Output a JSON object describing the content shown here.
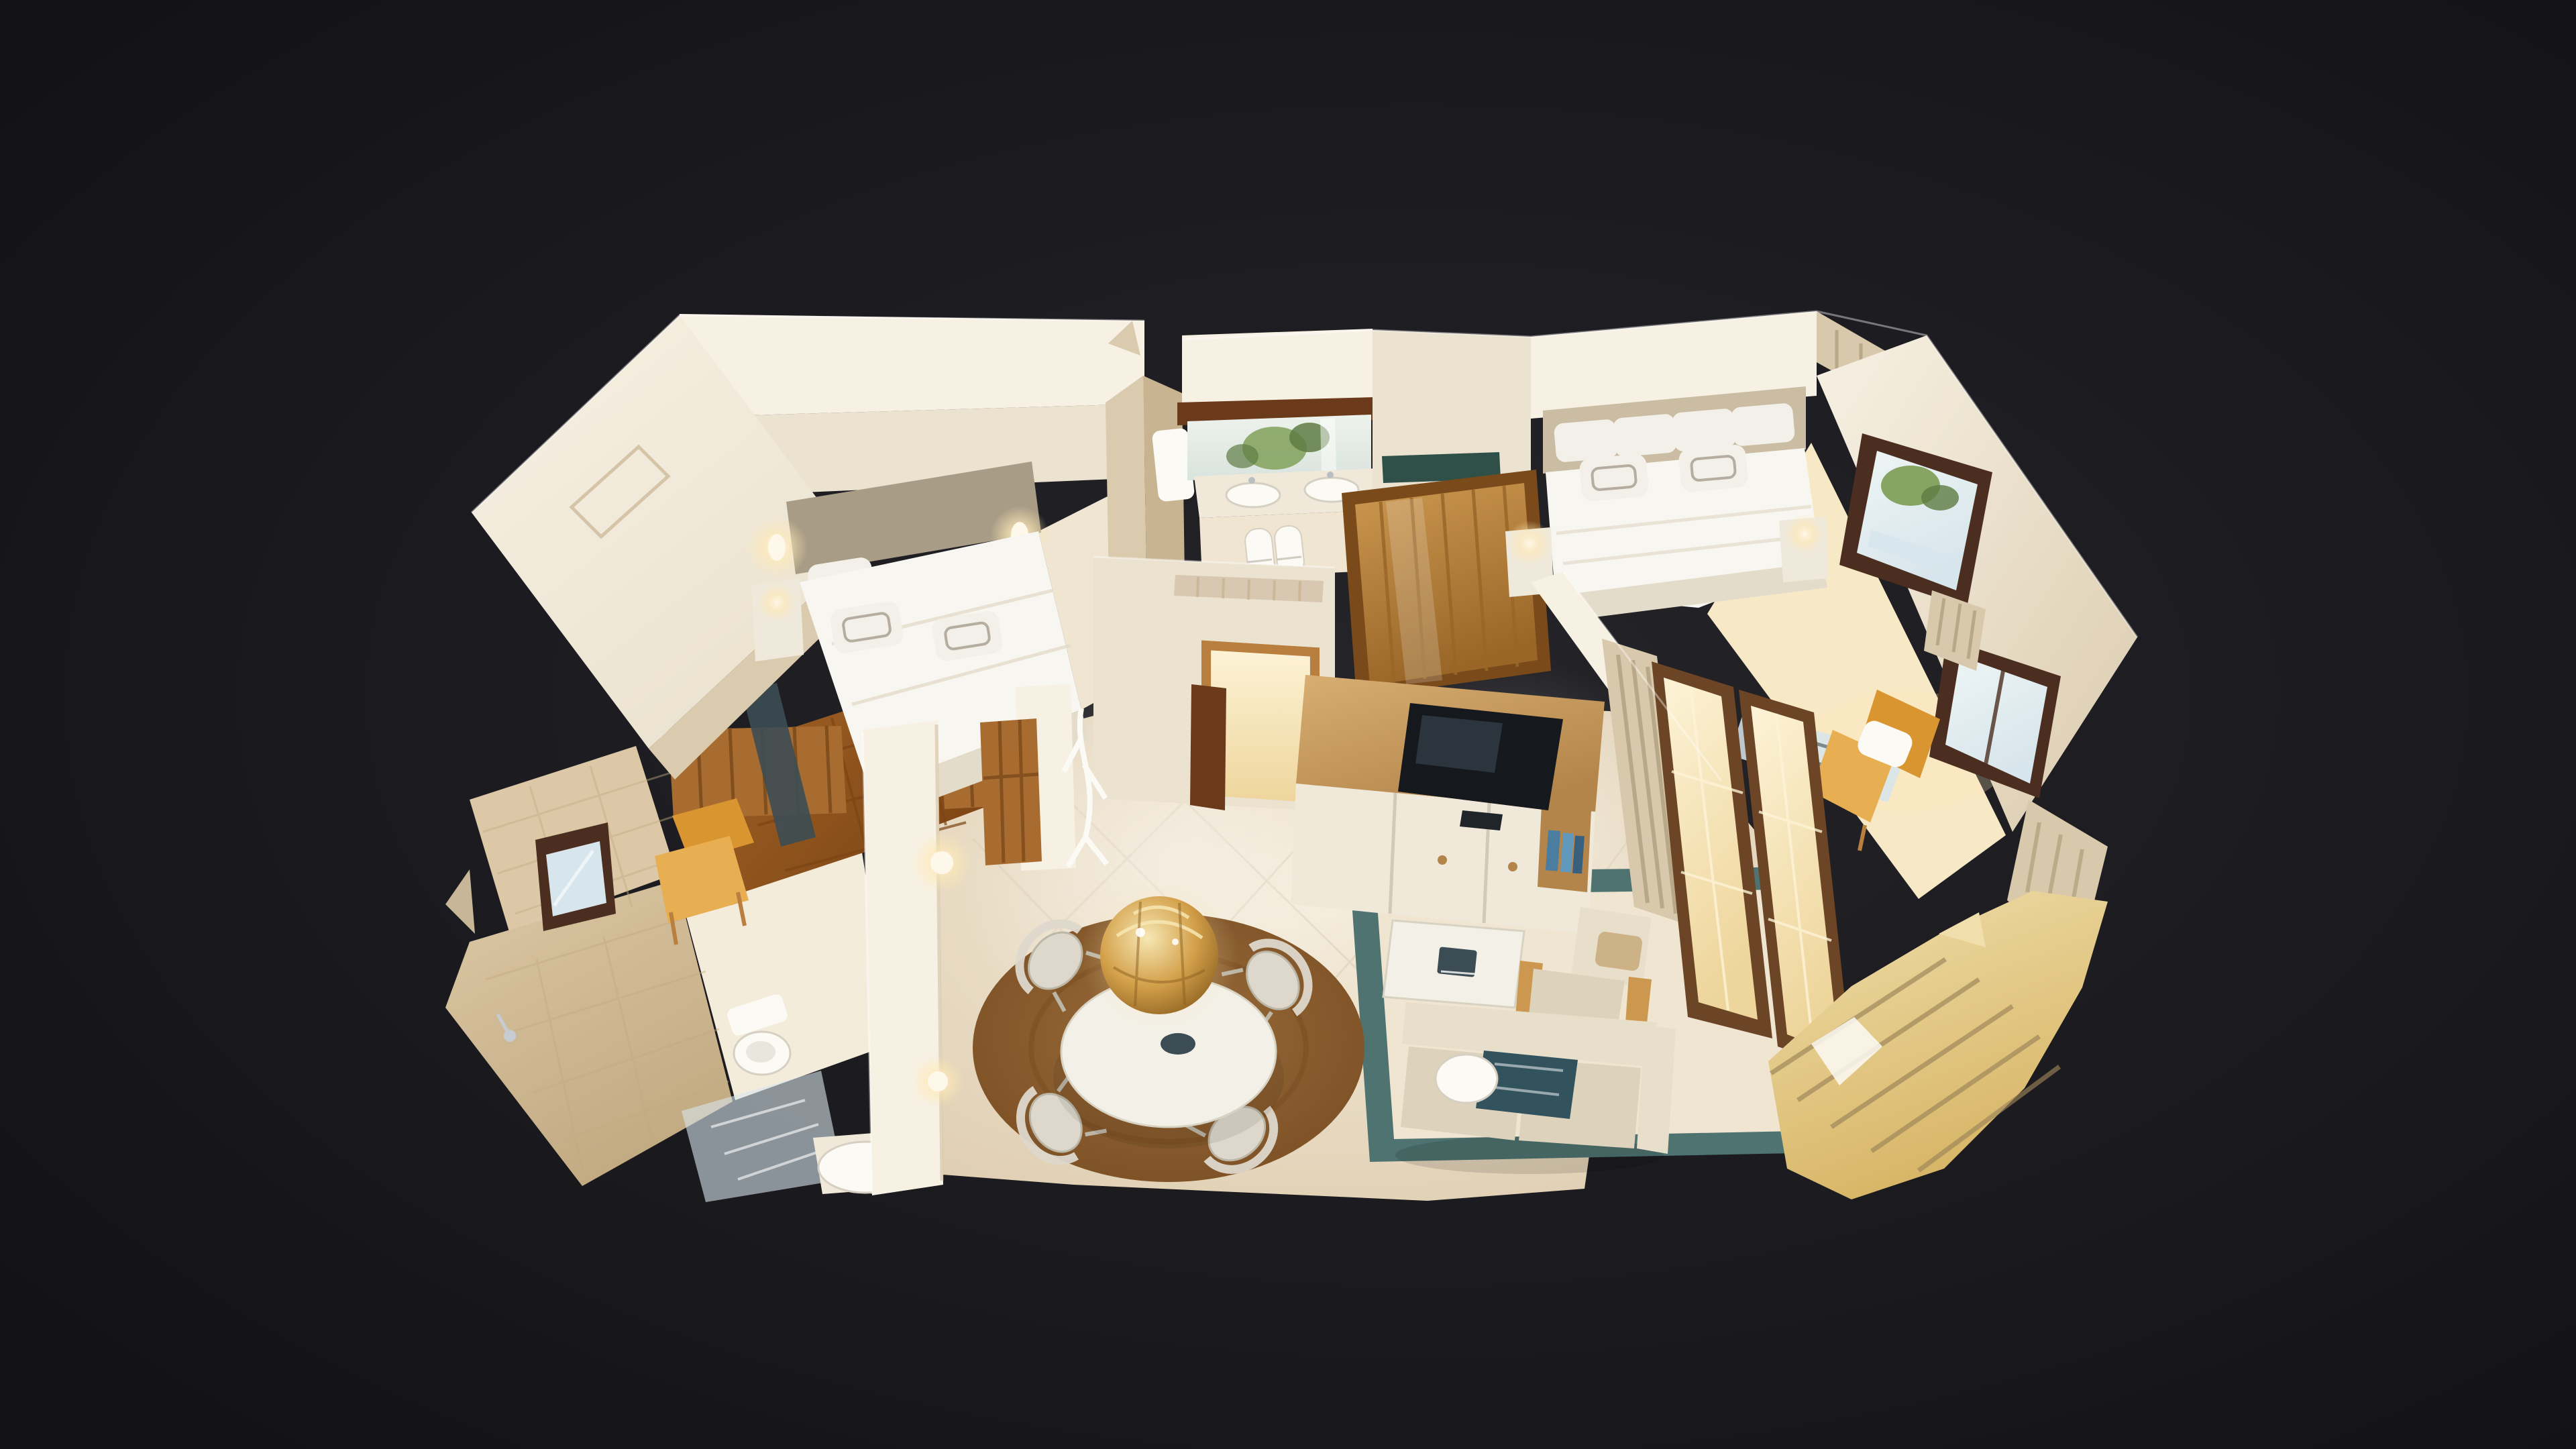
{
  "meta": {
    "view": "3D dollhouse cutaway of a furnished two-bedroom suite, photogrammetry scan floating on a dark backdrop",
    "visible_text": [],
    "controls_visible": []
  },
  "scene": {
    "rooms": [
      {
        "name": "bedroom-left",
        "items": [
          "double bed with white linens",
          "taupe headboard",
          "two lit wall sconces",
          "white nightstand with lamp",
          "wall picture frame",
          "mustard armchair",
          "dark marble threshold",
          "parquet doorway"
        ]
      },
      {
        "name": "ensuite-bathroom",
        "items": [
          "dark wood beam",
          "vanity mirror reflecting plants",
          "double white sinks",
          "rolled white towels",
          "white boiler cabinet",
          "torn scan walls"
        ]
      },
      {
        "name": "hall-wardrobe",
        "items": [
          "golden paneled wardrobe doors",
          "green marble shelf",
          "air vent grille",
          "wood-trimmed doorway with open dark door leaf",
          "white branch coat stand"
        ]
      },
      {
        "name": "bedroom-right",
        "items": [
          "double bed with white linens",
          "beige headboard",
          "two nightstand lamps",
          "two dark-framed windows with greenery view",
          "striped curtains",
          "glass desk",
          "mustard armchair with white pillow"
        ]
      },
      {
        "name": "bathroom",
        "items": [
          "beige tiled walls",
          "small dark-framed window",
          "toilet",
          "washbasin",
          "shower glass",
          "chrome shower head",
          "white pillar with lit wall lamps",
          "wooden door leaves"
        ]
      },
      {
        "name": "living-dining",
        "items": [
          "gold sphere chandelier",
          "oval white dining table",
          "four white hoop chairs",
          "round brown rug",
          "green marble floor border",
          "white coffee table with dark book",
          "beige wood-frame armchair",
          "beige sofa with teal throw and round pillow",
          "wood-top TV sideboard with white doors",
          "television",
          "blue books",
          "glowing balcony french windows",
          "striped curtains",
          "jagged balcony fragments"
        ]
      }
    ]
  },
  "palette": {
    "background_outer": "#121214",
    "background_mid": "#1b1b1f",
    "background_inner": "#242429",
    "wall_bright": "#f7f1e4",
    "wall_cream": "#ebe2cf",
    "wall_beige": "#dbcbae",
    "wall_tan": "#c9b492",
    "floor_marble_light": "#f4ecdb",
    "floor_marble": "#efe5d1",
    "floor_marble_dark": "#dcc9ab",
    "floor_grout": "#d8c8b2",
    "floor_warm": "#f7e9c6",
    "wood_floor": "#a26427",
    "wood_floor_dark": "#7c4414",
    "wood_door": "#a86c30",
    "wood_door_dark": "#7a4a1a",
    "wood_beam": "#6b3a1b",
    "wood_trim": "#b97f3f",
    "wood_frame_dark": "#4b2e1f",
    "wardrobe_wood": "#cc9850",
    "wardrobe_wood_dark": "#996628",
    "cabinet_wood": "#d8ae72",
    "cabinet_wood_dark": "#b3854a",
    "cabinet_front": "#f0e9da",
    "bed_white": "#f8f6f1",
    "bed_shadow": "#e3dccb",
    "headboard_taupe": "#a89c86",
    "headboard_beige": "#cbbda3",
    "pillow_white": "#f3f0ea",
    "pillow_trim": "#b5aea0",
    "pillow_pattern": "#cdb288",
    "nightstand_white": "#efe9dc",
    "glow_warm": "#ffe9b5",
    "glow_white": "#fdf8e9",
    "orange_chair": "#d9952f",
    "orange_chair_light": "#e8ae52",
    "teal_rug": "#4e7370",
    "teal_blanket": "#32525d",
    "rug_brown": "#9a6c3c",
    "rug_brown_dark": "#774c20",
    "table_white": "#f3f0e8",
    "chair_silver": "#ddd8cb",
    "chair_frame": "#bcb6a7",
    "gold_light": "#f7e7b4",
    "gold_mid": "#d3a04a",
    "gold_dark": "#8c6020",
    "sofa_beige": "#ddd2bc",
    "sofa_cushion": "#e8dfcb",
    "tv_black": "#15181c",
    "tv_glare": "#36424c",
    "books_blue": "#4a7da0",
    "books_blue2": "#6099bb",
    "books_blue_dark": "#38607e",
    "glass_cool": "#d7e5ec",
    "glass_sky": "#eef5f5",
    "green_foliage": "#87a462",
    "green_dark": "#5e7c43",
    "curtain_base": "#d8c9ad",
    "curtain_stripe": "#b2a07e",
    "mirror_hi": "#eef2ec",
    "mirror_lo": "#d9e3dd",
    "porcelain": "#fbfaf5",
    "porcelain_shadow": "#d6d0c2",
    "marble_threshold": "#3c4c54",
    "marble_green": "#2f5048",
    "french_hi": "#fdf3d6",
    "french_lo": "#eed59c",
    "french_frame": "#6b4526",
    "balcony_warm": "#f0dfad",
    "balcony_deep": "#d7b464",
    "tile_beige": "#dcc8a6",
    "tile_dark": "#c2aa82",
    "white": "#ffffff"
  }
}
